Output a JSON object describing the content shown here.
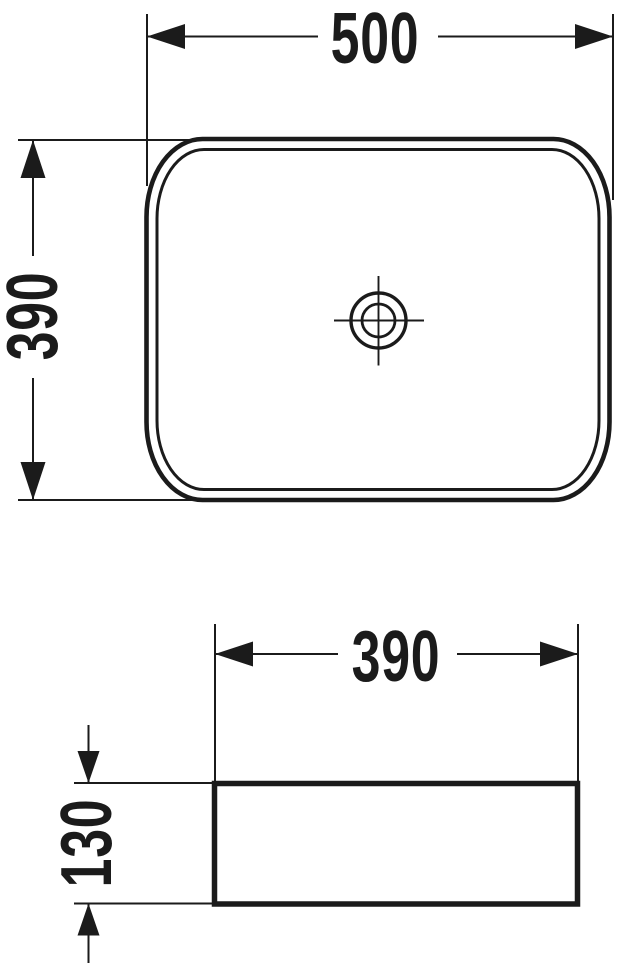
{
  "drawing": {
    "kind": "technical-dimension-drawing",
    "line_color": "#1b1b1b",
    "background_color": "#ffffff",
    "symbols": {
      "drain": "drain-crosshair-symbol"
    }
  },
  "dims": {
    "top_width": "500",
    "top_depth": "390",
    "front_width": "390",
    "front_height": "130"
  }
}
